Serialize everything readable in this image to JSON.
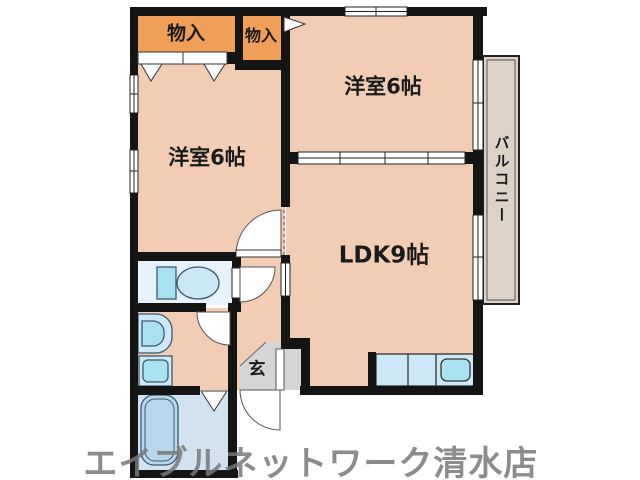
{
  "labels": {
    "room1": "洋室6帖",
    "room2": "洋室6帖",
    "ldk": "LDK9帖",
    "balcony": "バルコニー",
    "entrance": "玄",
    "closet_large": "物入",
    "closet_small": "物入"
  },
  "watermark": "エイブルネットワーク清水店",
  "colors": {
    "wall": "#141414",
    "floor": "#f3cdb3",
    "closet": "#ef9f58",
    "balcony": "#dcd2c8",
    "genkan": "#d5d5d5",
    "toiletfloor": "#e7f2fa",
    "bathfloor": "#d2e2f0",
    "fixture": "#cde9f7",
    "fixturedeep": "#a9e0f2",
    "line": "#444444",
    "watermark": "#787878"
  }
}
